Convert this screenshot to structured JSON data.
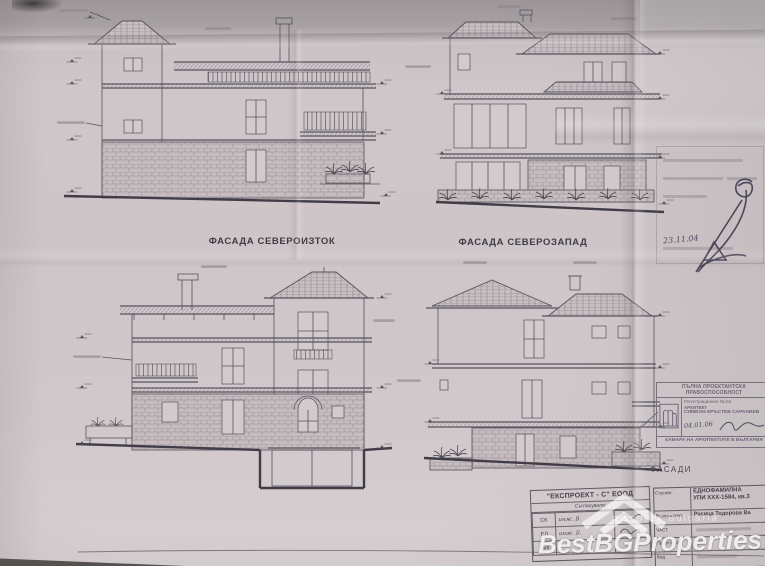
{
  "sheet": {
    "facade_northeast_label": "ФАСАДА СЕВЕРОИЗТОК",
    "facade_northwest_label": "ФАСАДА СЕВЕРОЗАПАД",
    "drawing_set_label": "ФАСАДИ"
  },
  "approval_stamp": {
    "handwritten_date": "23.11.04"
  },
  "architect_stamp": {
    "title": "ПЪЛНА ПРОЕКТАНТСКА ПРАВОСПОСОБНОСТ",
    "registration": "Регистрационен № 02",
    "role": "АРХИТЕКТ",
    "name": "СИМЕОН КРЪСТЕВ САРАЛИЕВ",
    "handwritten_date": "04.01.06",
    "footer": "КАМАРА НА АРХИТЕКТИТЕ В БЪЛГАРИЯ"
  },
  "title_block": {
    "company": "\"ЕКСПРОЕКТ - С\" ЕООД",
    "signatories_header": "Съгласували:",
    "signatories": [
      {
        "label": "СК",
        "name": "инж. В."
      },
      {
        "label": "ЕЛ",
        "name": "инж. Б."
      },
      {
        "label": "ВиК",
        "name": ""
      }
    ],
    "project": {
      "label": "Строеж:",
      "line1": "ЕДНОФАМИЛНА",
      "line2": "УПИ XXX-1584, кв.3"
    },
    "client": {
      "label": "Възложител:",
      "value": "Росица Тодорова Ва"
    },
    "part": {
      "label": "ЧАСТ",
      "value": ""
    },
    "designer": {
      "label": "Проектант:",
      "value": "арх."
    },
    "kind": {
      "label": "Вид",
      "value": ""
    }
  },
  "watermark": {
    "brand": "BestBGProperties",
    "tagline": "discover Bulgaria"
  },
  "colors": {
    "paper": "#cdc4c6",
    "ink": "#56535d",
    "stamp_ink": "#7b7280",
    "watermark": "#ffffff"
  }
}
